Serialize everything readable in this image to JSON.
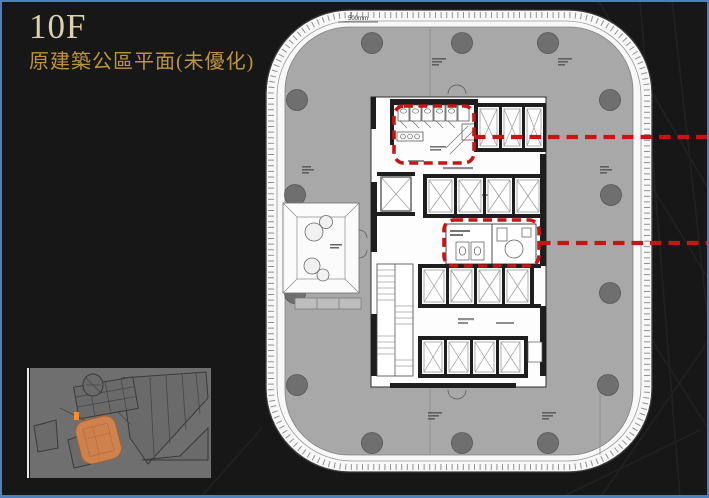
{
  "slide": {
    "title": "10F",
    "subtitle": "原建築公區平面(未優化)",
    "background_color": "#171717",
    "border_color": "#4e80bd",
    "title_color": "#ddd2ae",
    "subtitle_color": "#bd9440"
  },
  "plan": {
    "name": "original-common-area-floor-plan-10F",
    "dimension_label": "500mm",
    "floor_color": "#a8a8a8",
    "column_color": "#6f6f6f",
    "highlight_color": "#c81414",
    "highlight_boxes": [
      {
        "id": "highlight-box-1",
        "area": "upper-core-restroom-zone"
      },
      {
        "id": "highlight-box-2",
        "area": "central-core-restroom-zone"
      }
    ]
  },
  "thumbnail": {
    "name": "site-key-plan",
    "highlight_color": "#d8854a"
  }
}
